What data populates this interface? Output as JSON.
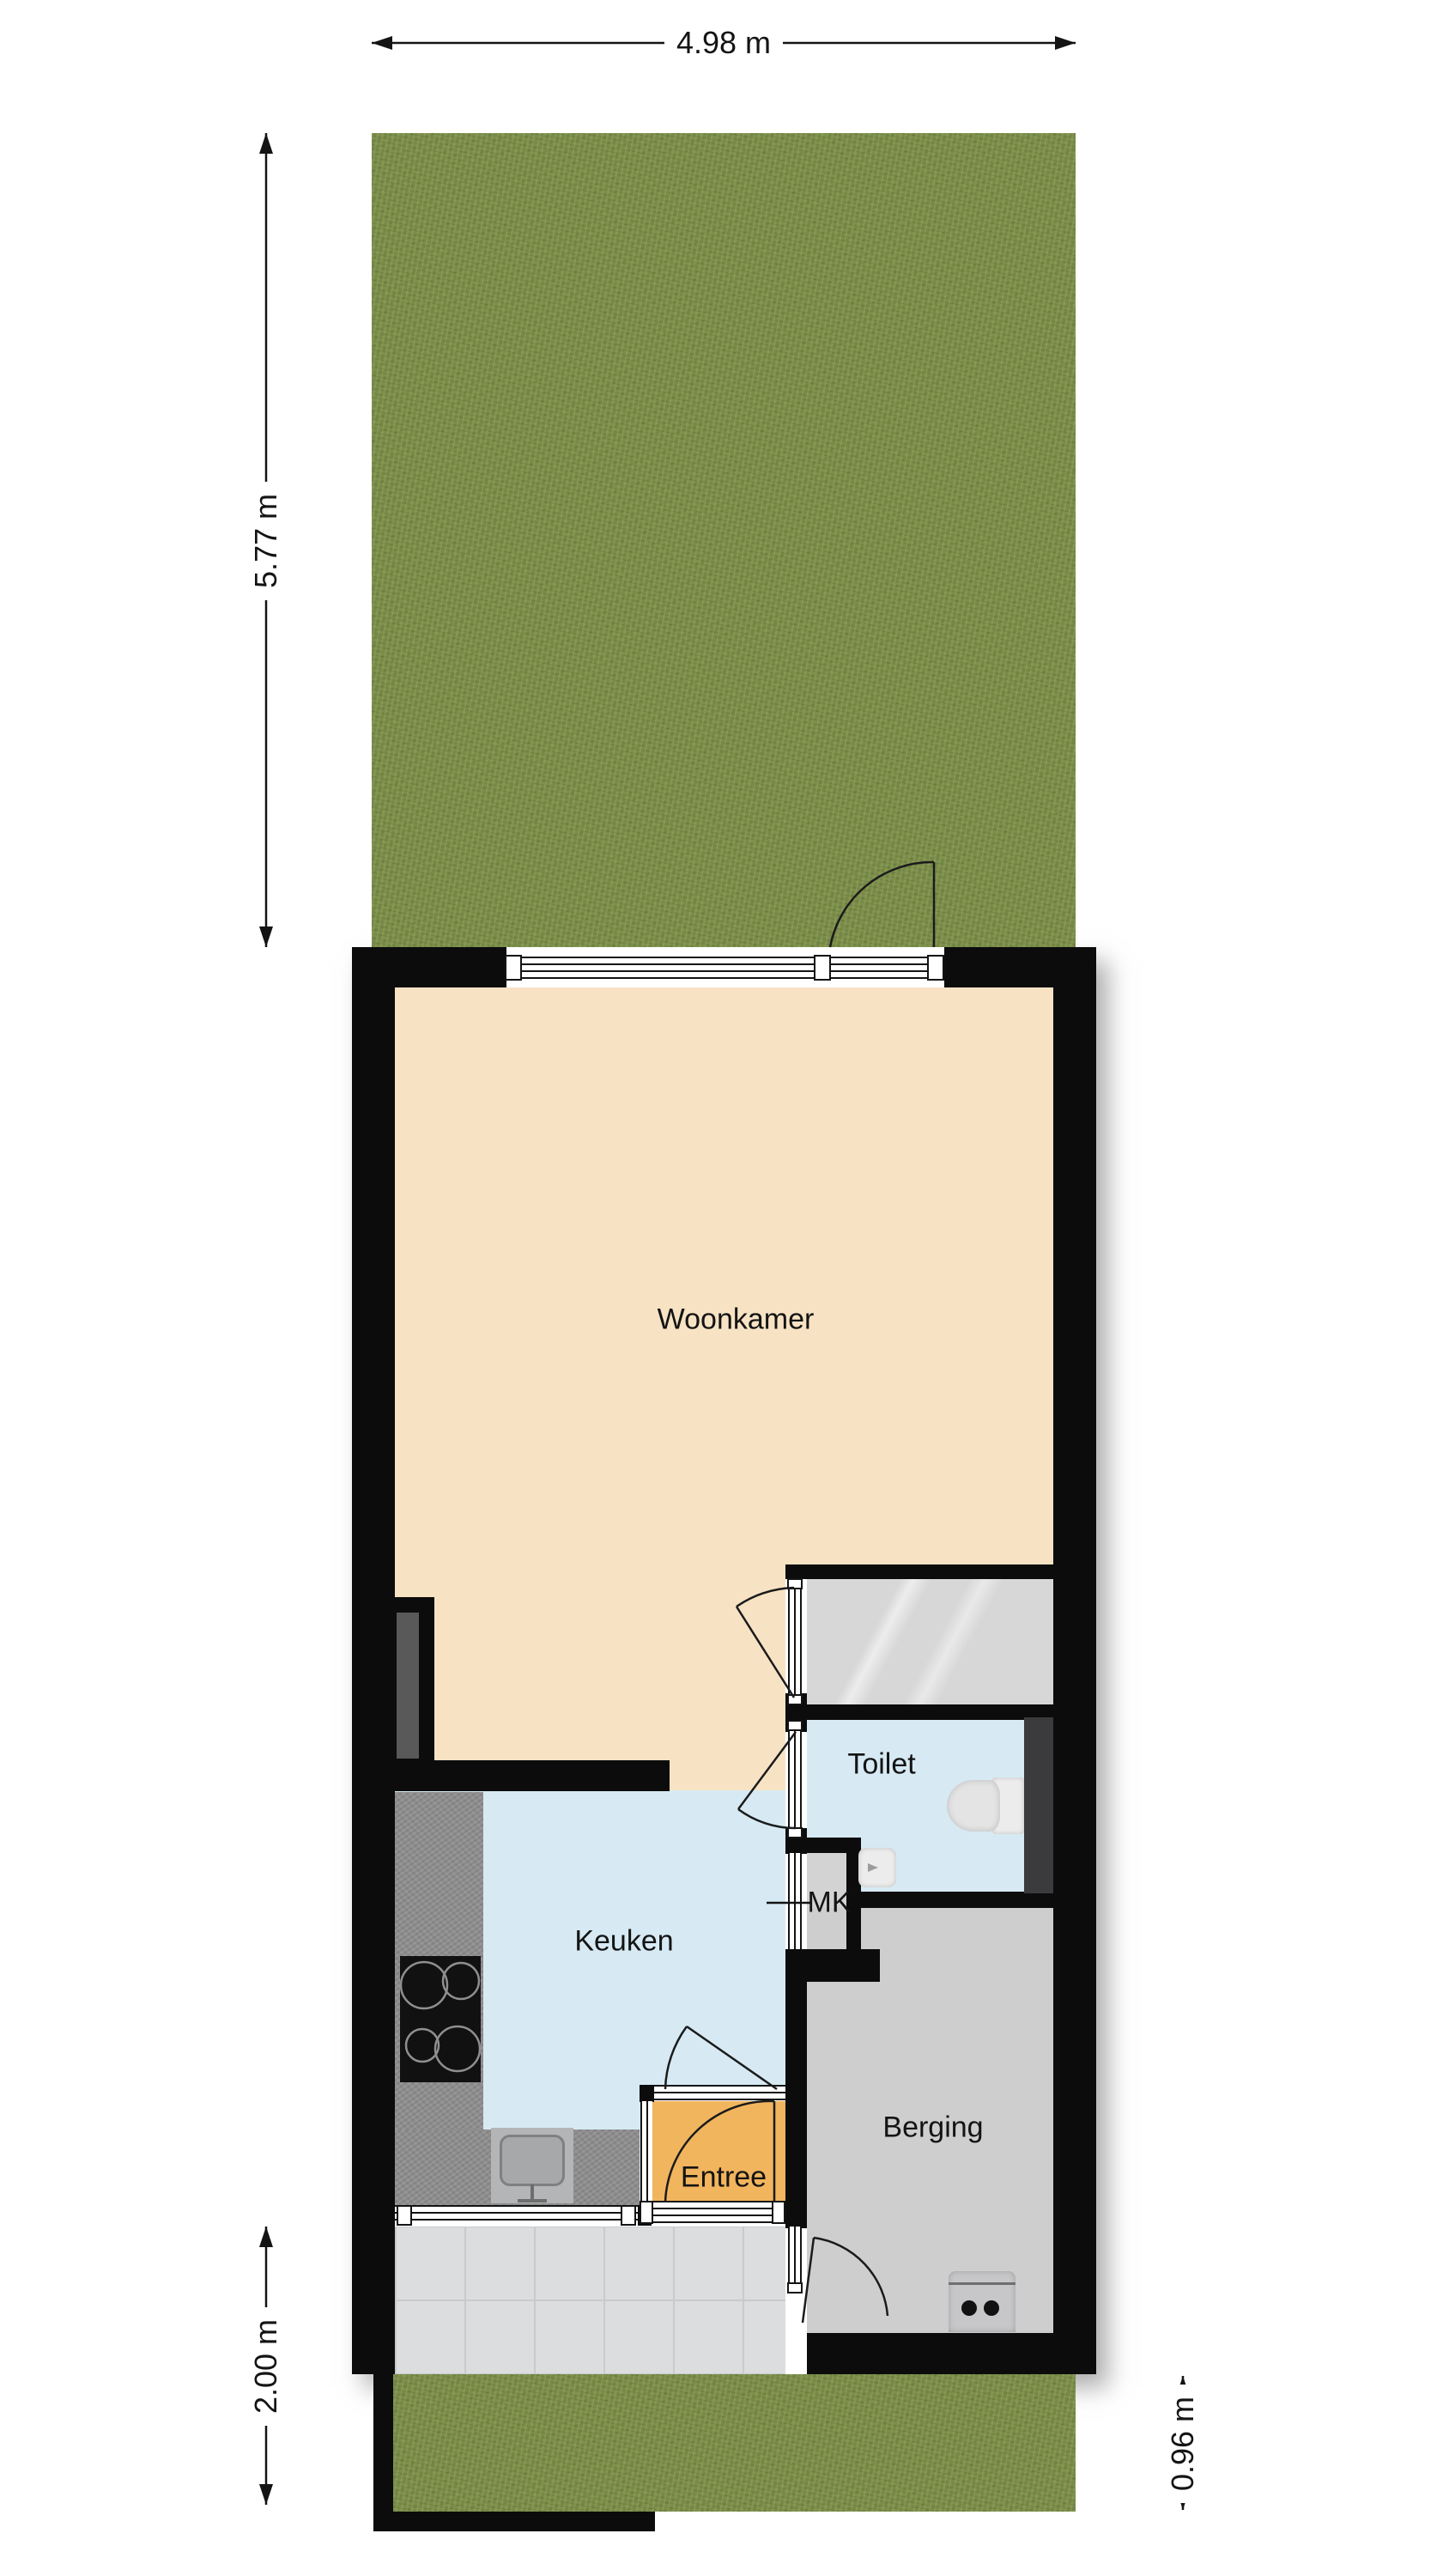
{
  "rooms": {
    "woonkamer": "Woonkamer",
    "keuken": "Keuken",
    "toilet": "Toilet",
    "mk": "MK",
    "entree": "Entree",
    "berging": "Berging"
  },
  "dimensions": {
    "top": "4.98 m",
    "left": "5.77 m",
    "bottom_left": "2.00 m",
    "bottom_right": "0.96 m"
  },
  "colors": {
    "wall": "#0c0c0c",
    "living_floor": "#f7e3c4",
    "kitchen_floor": "#d7eaf3",
    "toilet_floor": "#d7eaf3",
    "entry_floor": "#f1b55e",
    "storage_floor": "#cecece",
    "stair_floor": "#d9d9d9",
    "porch_floor": "#dcddde",
    "grass": "#7a8d4a",
    "counter": "#8e8e8e",
    "shaft": "#3b3b3d"
  }
}
